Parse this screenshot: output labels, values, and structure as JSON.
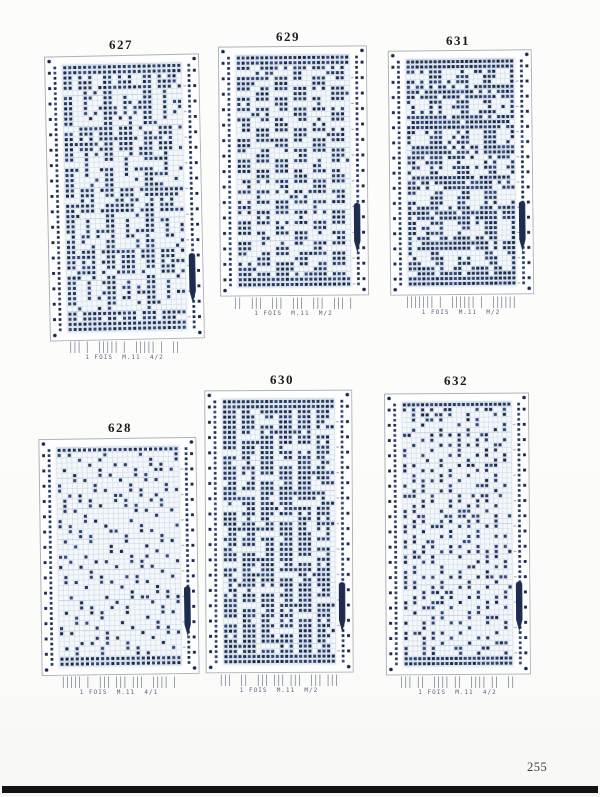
{
  "page": {
    "number": "255"
  },
  "colors": {
    "dot": "#253a60",
    "dot_dark": "#182a4c",
    "dot_light": "#31497a",
    "card_fill": "#fefefe",
    "pattern_fill": "#f5f8fb",
    "card_outline": "#9aa0a6",
    "grid": "#b9c6d8",
    "grid_strong": "#a6b6cc",
    "clip": "#1d2c50",
    "row_marks": "#94a2b8"
  },
  "cards": [
    {
      "number": "627",
      "caption": "1 FOIS  M.11  4/2",
      "ticks": "||| |  ||||| |  ||||| |  ||",
      "pattern": "lace",
      "seed": 3,
      "dense_top": 2,
      "clip_frac": 0.7,
      "layout": {
        "x": 47,
        "y": 55,
        "w": 155,
        "h": 285,
        "rot": -1.2,
        "title_x": 121,
        "title_y": 37
      }
    },
    {
      "number": "629",
      "caption": "1 FOIS  M.11  M/2",
      "ticks": "||  |||  |||  |||  |||  ||| |",
      "pattern": "cluster",
      "seed": 5,
      "dense_top": 2,
      "clip_frac": 0.63,
      "layout": {
        "x": 219,
        "y": 46,
        "w": 149,
        "h": 250,
        "rot": -0.5,
        "title_x": 288,
        "title_y": 29
      }
    },
    {
      "number": "631",
      "caption": "1 FOIS  M.11  M/2",
      "ticks": "||||||| |  |||||| |  ||||||",
      "pattern": "maze",
      "seed": 9,
      "dense_top": 2,
      "clip_frac": 0.62,
      "layout": {
        "x": 389,
        "y": 50,
        "w": 144,
        "h": 245,
        "rot": -0.6,
        "title_x": 458,
        "title_y": 33
      }
    },
    {
      "number": "628",
      "caption": "1 FOIS  M.11  4/1",
      "ticks": "||||| |  ||| ||| |||  |||| |",
      "pattern": "sparse",
      "seed": 11,
      "dense_top": 1,
      "clip_frac": 0.63,
      "layout": {
        "x": 40,
        "y": 438,
        "w": 158,
        "h": 237,
        "rot": -0.8,
        "title_x": 120,
        "title_y": 420
      }
    },
    {
      "number": "630",
      "caption": "1 FOIS  M.11  M/2",
      "ticks": "|||  ||  ||| ||| |||  ||| |||",
      "pattern": "stripes",
      "seed": 7,
      "dense_top": 2,
      "clip_frac": 0.68,
      "layout": {
        "x": 205,
        "y": 390,
        "w": 148,
        "h": 283,
        "rot": -0.3,
        "title_x": 282,
        "title_y": 372
      }
    },
    {
      "number": "632",
      "caption": "1 FOIS  M.11  4/2",
      "ticks": "||| ||  |||| ||  |||| ||  ||",
      "pattern": "diag",
      "seed": 13,
      "dense_top": 1,
      "clip_frac": 0.67,
      "layout": {
        "x": 385,
        "y": 393,
        "w": 145,
        "h": 282,
        "rot": -0.4,
        "title_x": 456,
        "title_y": 373
      }
    }
  ]
}
